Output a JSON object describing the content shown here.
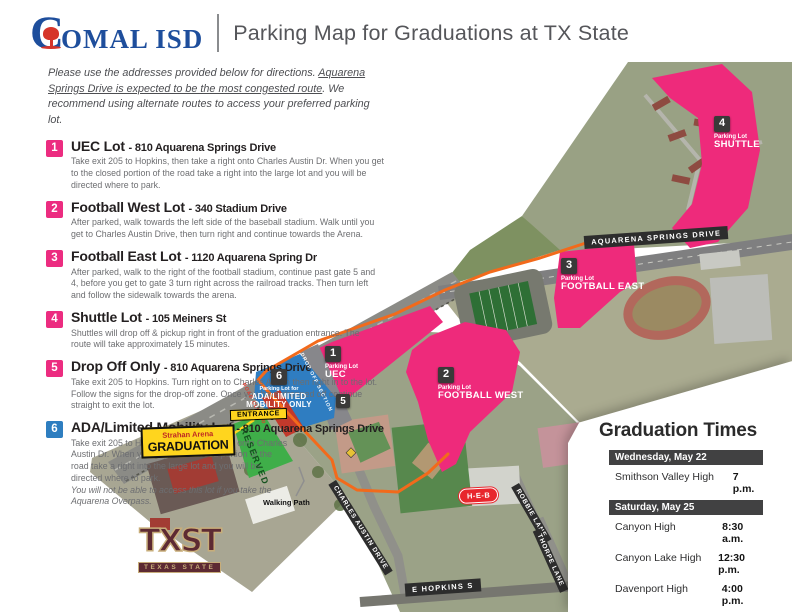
{
  "header": {
    "logo_c": "C",
    "logo_rest": "OMAL ISD",
    "title": "Parking Map for Graduations at TX State"
  },
  "ui": {
    "dash": "-"
  },
  "intro": {
    "part1": "Please use the addresses provided below for directions. ",
    "part2": "Aquarena Springs Drive is expected to be the most congested route",
    "part3": ". We recommend using alternate routes to access your preferred parking lot."
  },
  "lots": [
    {
      "num": "1",
      "name": "UEC Lot",
      "address": "810 Aquarena Springs Drive",
      "desc": "Take exit 205 to Hopkins, then take a right onto Charles Austin Dr. When you get to the closed portion of the road take a right into the large lot and you will be directed where to park."
    },
    {
      "num": "2",
      "name": "Football West Lot",
      "address": "340 Stadium Drive",
      "desc": "After parked, walk towards the left side of the baseball stadium. Walk until you get to Charles Austin Drive, then turn right and continue towards the Arena."
    },
    {
      "num": "3",
      "name": "Football East Lot",
      "address": "1120 Aquarena Spring Dr",
      "desc": "After parked, walk to the right of the football stadium, continue past gate 5 and 4, before you get to gate 3 turn right across the railroad tracks. Then turn left and follow the sidewalk towards the arena."
    },
    {
      "num": "4",
      "name": "Shuttle Lot",
      "address": "105 Meiners St",
      "desc": "Shuttles will drop off & pickup right in front of the graduation entrance. The route will take approximately 15 minutes."
    },
    {
      "num": "5",
      "name": "Drop Off Only",
      "address": "810 Aquarena Springs Drive",
      "desc": "Take exit 205 to Hopkins. Turn right on to Charles Austin then right in to the lot. Follow the signs for the drop-off zone. Once you have dropped off continue straight to exit the lot."
    },
    {
      "num": "6",
      "name": "ADA/Limited Mobility Lot",
      "address": "810 Aquarena Springs Drive",
      "desc": "Take exit 205 to Hopkins, then take a right onto Charles Austin Dr. When you get to the closed portion of the road take a right into the large lot and you will be directed where to park.",
      "note": "You will not be able to access this lot if you take the Aquarena Overpass."
    }
  ],
  "map": {
    "streets": {
      "aquarena": "AQUARENA SPRINGS DRIVE",
      "charles_austin": "CHARLES AUSTIN DRIVE",
      "robbie": "ROBBIE LANE",
      "thorpe": "THORPE LANE",
      "hopkins": "E HOPKINS S"
    },
    "markers": {
      "uec": {
        "num": "1",
        "line1": "Parking Lot",
        "line2": "UEC"
      },
      "football_west": {
        "num": "2",
        "line1": "Parking Lot",
        "line2": "FOOTBALL WEST"
      },
      "football_east": {
        "num": "3",
        "line1": "Parking Lot",
        "line2": "FOOTBALL EAST"
      },
      "shuttle": {
        "num": "4",
        "line1": "Parking Lot",
        "line2": "SHUTTLE"
      },
      "ada": {
        "num": "6",
        "line1": "Parking Lot for",
        "line2": "ADA/LIMITED",
        "line3": "MOBILITY ONLY"
      },
      "dropoff_num": "5"
    },
    "labels": {
      "entrance": "ENTRANCE",
      "arena_line1": "Strahan Arena",
      "arena_line2": "GRADUATION",
      "reserved": "RESERVED",
      "walking_path": "Walking Path",
      "drop_off_section": "DROP OFF SECTION",
      "road_closed": "ROAD CLOSED",
      "heb": "H-E-B",
      "txst": "TXST",
      "txst_sub": "TEXAS STATE"
    }
  },
  "times": {
    "title": "Graduation Times",
    "sections": [
      {
        "date": "Wednesday, May 22",
        "rows": [
          {
            "school": "Smithson Valley High",
            "time": "7 p.m."
          }
        ]
      },
      {
        "date": "Saturday, May 25",
        "rows": [
          {
            "school": "Canyon High",
            "time": "8:30 a.m."
          },
          {
            "school": "Canyon Lake High",
            "time": "12:30 p.m."
          },
          {
            "school": "Davenport High",
            "time": "4:00 p.m."
          },
          {
            "school": "Pieper High",
            "time": "7:30 p.m."
          }
        ]
      }
    ]
  },
  "colors": {
    "lot_pink": "#ee2a7b",
    "ada_blue": "#2f7dc1",
    "reserved_green": "#3fae49",
    "route_orange": "#f26a1b",
    "highlight_yellow": "#ffd51e",
    "logo_blue": "#1e4e9c",
    "logo_red": "#d6352b"
  }
}
